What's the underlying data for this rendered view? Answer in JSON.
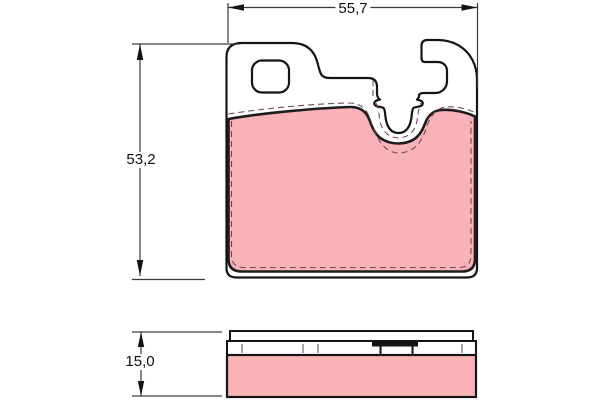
{
  "drawing": {
    "dimensions": {
      "width_label": "55,7",
      "height_label": "53,2",
      "thickness_label": "15,0"
    },
    "colors": {
      "friction_material": "#F9B2B8",
      "outline": "#141414",
      "dimension_line": "#3a3a3a",
      "hidden_edge_dash": "#74484e",
      "background": "#FFFFFF"
    }
  }
}
